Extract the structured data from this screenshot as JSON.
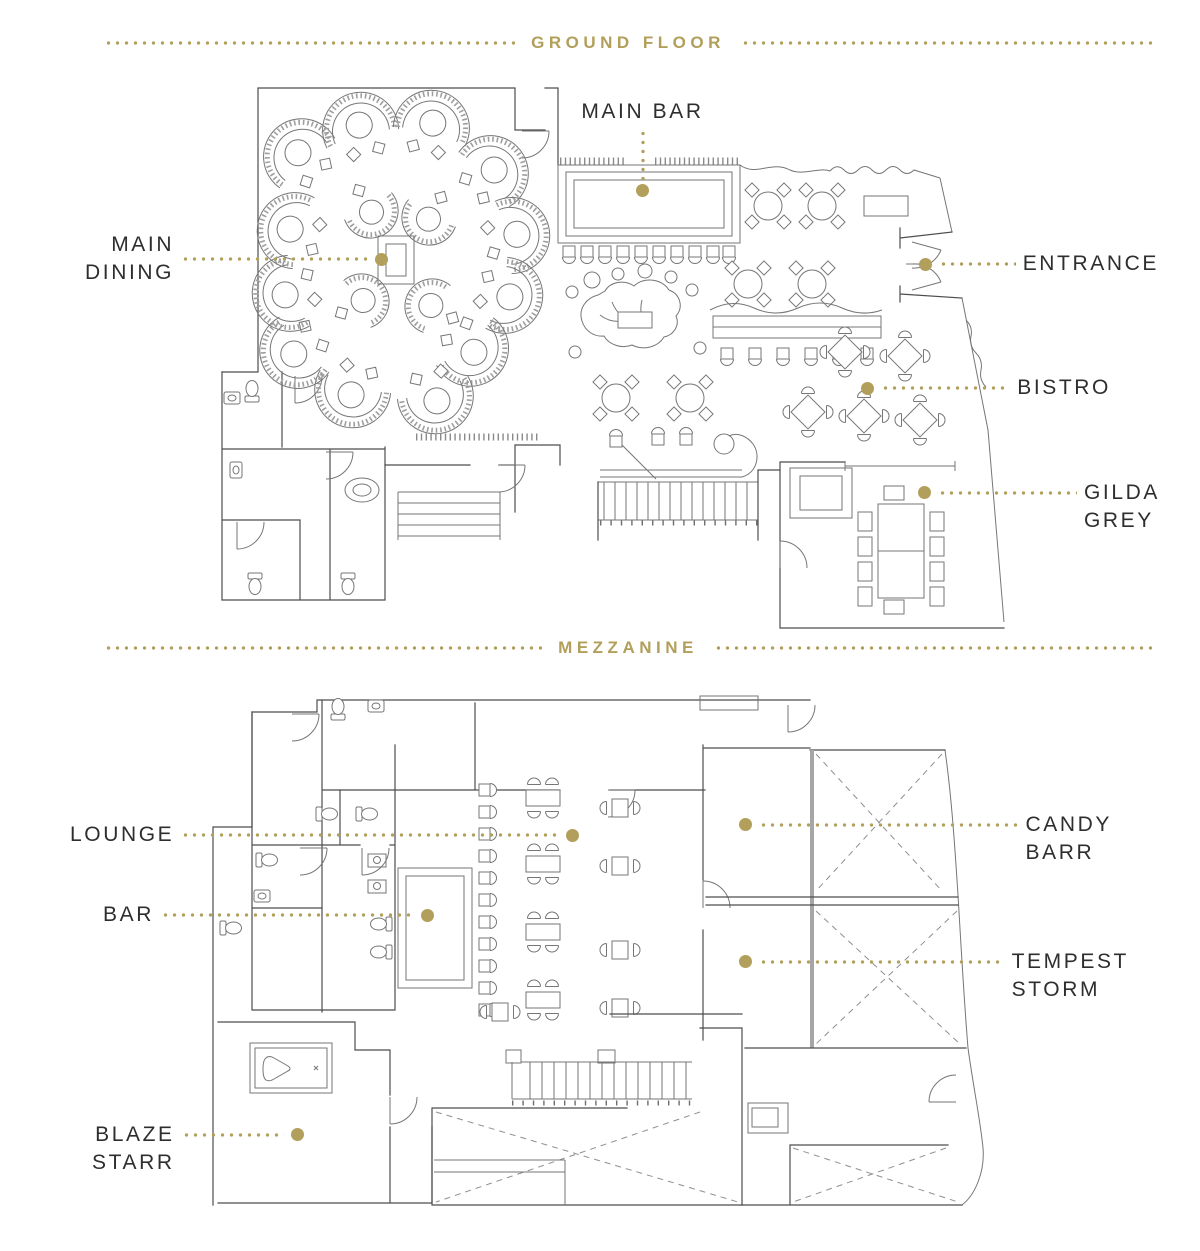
{
  "colors": {
    "accent_gold": "#b29f5b",
    "label_ink": "#2e2e2e"
  },
  "headers": {
    "ground_floor": "GROUND FLOOR",
    "mezzanine": "MEZZANINE"
  },
  "labels": {
    "main_bar": "MAIN BAR",
    "main_dining": "MAIN\nDINING",
    "entrance": "ENTRANCE",
    "bistro": "BISTRO",
    "gilda_grey": "GILDA\nGREY",
    "lounge": "LOUNGE",
    "bar": "BAR",
    "candy_barr": "CANDY\nBARR",
    "tempest_storm": "TEMPEST\nSTORM",
    "blaze_starr": "BLAZE\nSTARR"
  }
}
